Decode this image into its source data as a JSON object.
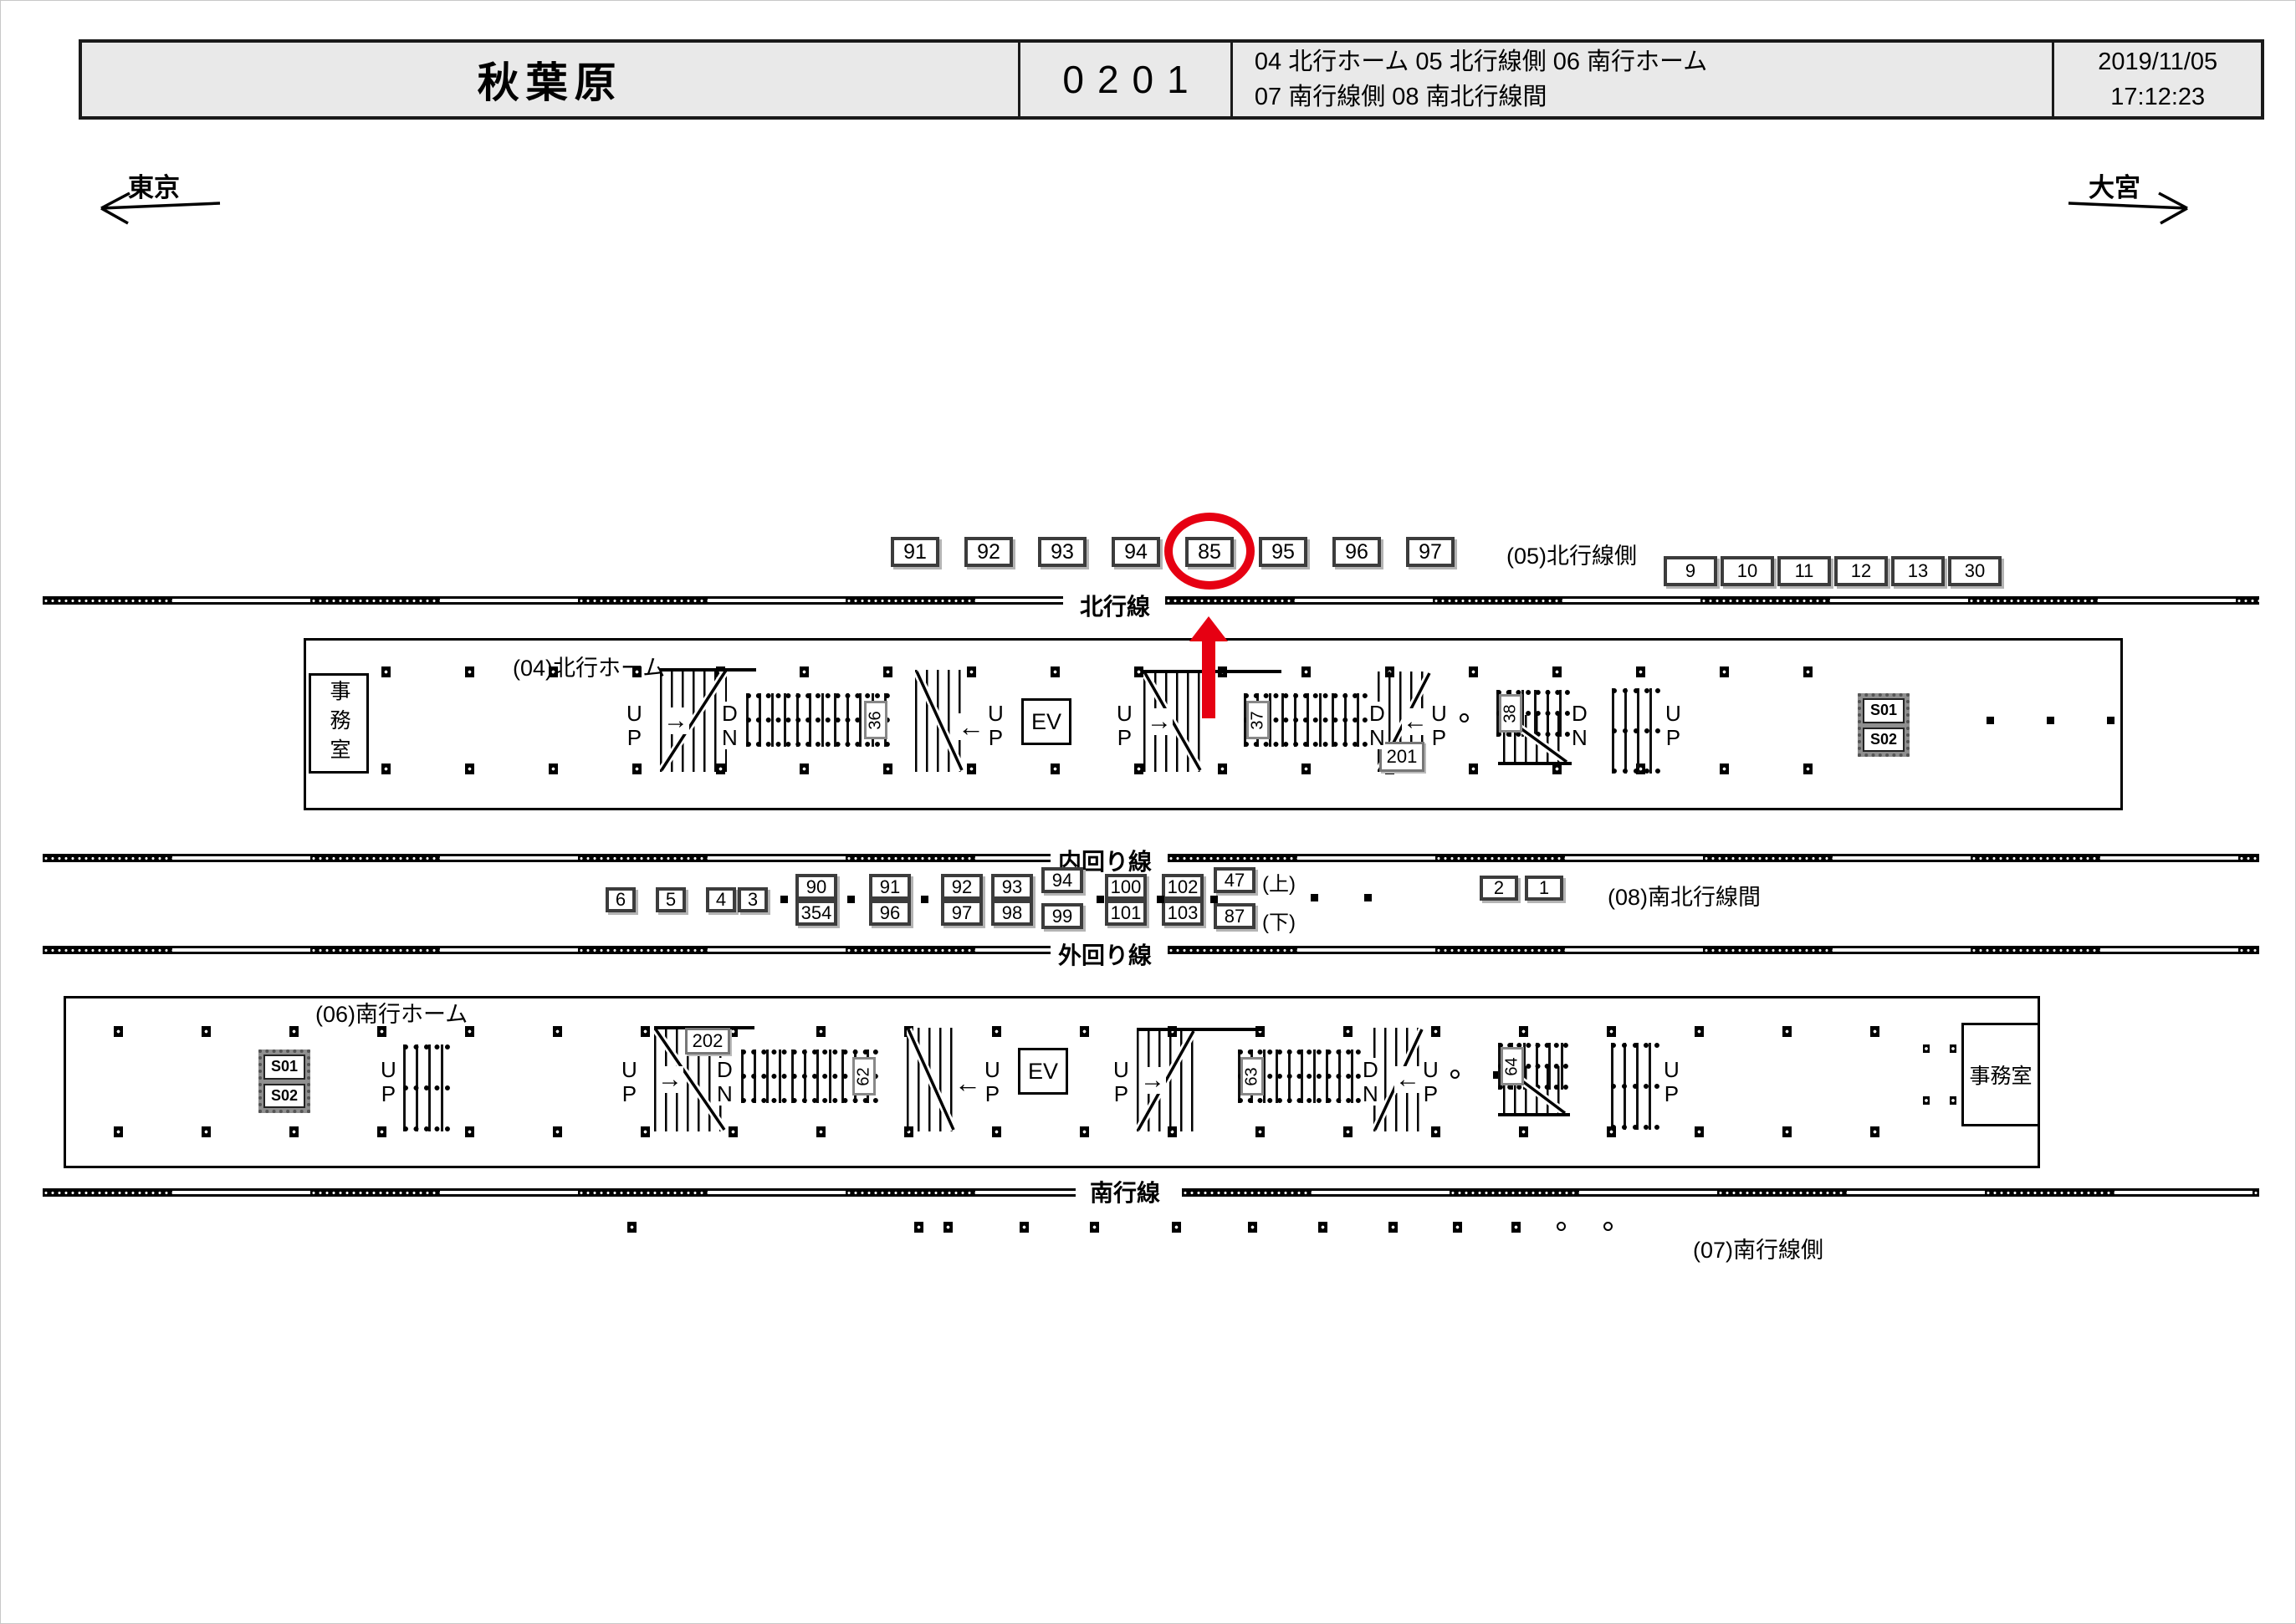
{
  "header": {
    "station": "秋葉原",
    "code": "0201",
    "legend_line1": "04 北行ホーム  05 北行線側  06 南行ホーム",
    "legend_line2": "07 南行線側  08 南北行線間",
    "date": "2019/11/05",
    "time": "17:12:23"
  },
  "directions": {
    "left_label": "東京",
    "right_label": "大宮"
  },
  "track_labels": {
    "northbound": "北行線",
    "inner_loop": "内回り線",
    "outer_loop": "外回り線",
    "southbound": "南行線"
  },
  "row05": {
    "label": "(05)北行線側",
    "cameras": [
      "91",
      "92",
      "93",
      "94",
      "85",
      "95",
      "96",
      "97"
    ],
    "highlighted": "85",
    "right_cameras": [
      "9",
      "10",
      "11",
      "12",
      "13",
      "30"
    ]
  },
  "row08": {
    "label": "(08)南北行線間",
    "left_singles": [
      "6",
      "5",
      "4",
      "3"
    ],
    "pairs": [
      [
        "90",
        "354"
      ],
      [
        "91",
        "96"
      ],
      [
        "92",
        "97"
      ],
      [
        "93",
        "98"
      ],
      [
        "94",
        "99"
      ],
      [
        "100",
        "101"
      ],
      [
        "102",
        "103"
      ],
      [
        "47",
        "87"
      ]
    ],
    "up_note": "(上)",
    "down_note": "(下)",
    "right_singles": [
      "2",
      "1"
    ]
  },
  "row07": {
    "label": "(07)南行線側"
  },
  "platform04": {
    "label": "(04)北行ホーム",
    "office_label": "事務室",
    "ev_label": "EV",
    "up_label": "U\nP",
    "dn_label": "D\nN",
    "escalator_numbers": [
      "36",
      "37",
      "38"
    ],
    "stair_number": "201",
    "service_labels": [
      "S01",
      "S02"
    ]
  },
  "platform06": {
    "label": "(06)南行ホーム",
    "office_label": "事務室",
    "ev_label": "EV",
    "up_label": "U\nP",
    "dn_label": "D\nN",
    "escalator_numbers": [
      "62",
      "63",
      "64"
    ],
    "stair_number": "202",
    "service_labels": [
      "S01",
      "S02"
    ]
  },
  "icons": {
    "arrow_right": "→",
    "arrow_left": "←"
  },
  "colors": {
    "highlight_red": "#e60012",
    "header_bg": "#e9e9e9"
  }
}
